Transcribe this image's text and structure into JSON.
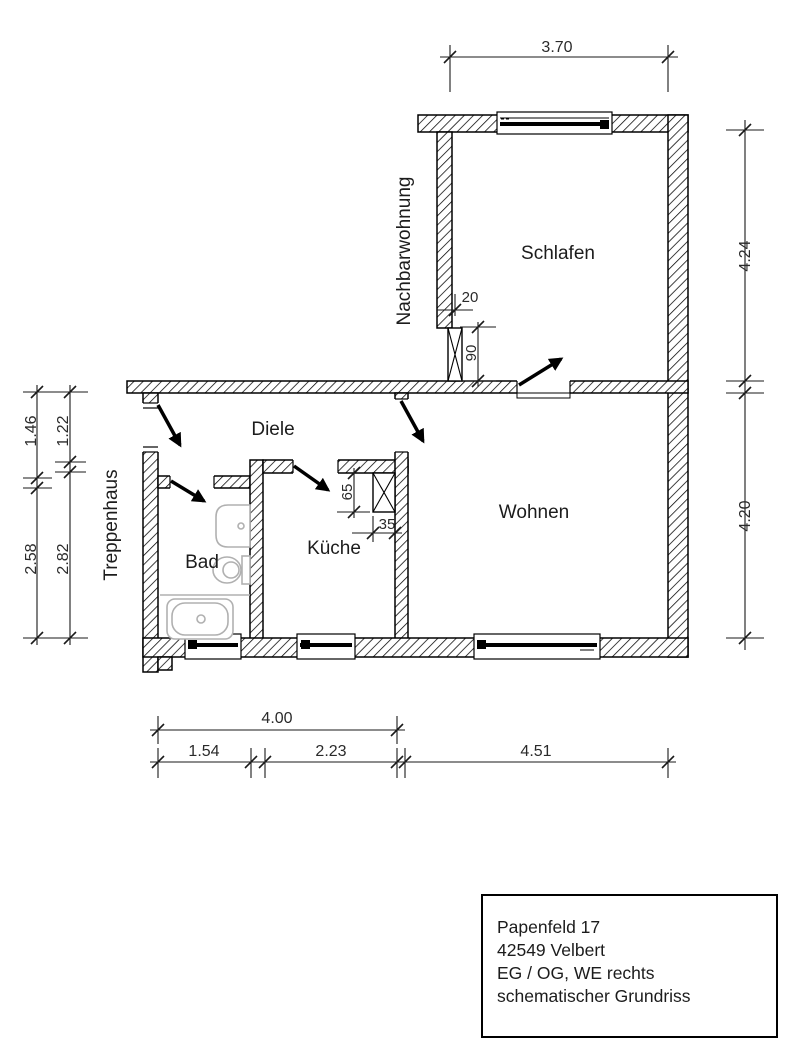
{
  "rooms": {
    "schlafen": "Schlafen",
    "diele": "Diele",
    "bad": "Bad",
    "kueche": "Küche",
    "wohnen": "Wohnen"
  },
  "adjacent": {
    "nachbarwohnung": "Nachbarwohnung",
    "treppenhaus": "Treppenhaus"
  },
  "dimensions_m": {
    "top_width": "3.70",
    "right_upper": "4.24",
    "right_lower": "4.20",
    "left_outer_upper": "1.46",
    "left_inner_upper": "1.22",
    "left_outer_lower": "2.58",
    "left_inner_lower": "2.82",
    "bottom_total": "4.00",
    "bottom_bad": "1.54",
    "bottom_kueche": "2.23",
    "bottom_wohnen": "4.51"
  },
  "dimensions_cm": {
    "schlafen_shaft_width": "20",
    "schlafen_shaft_length": "90",
    "kueche_shaft_length": "65",
    "kueche_shaft_width": "35"
  },
  "title_block": {
    "address_line1": "Papenfeld 17",
    "address_line2": "42549 Velbert",
    "unit_line": "EG / OG, WE rechts",
    "type_line": "schematischer Grundriss"
  },
  "colors": {
    "line": "#000000",
    "fixtures": "#b0b0b0",
    "background": "#ffffff"
  }
}
